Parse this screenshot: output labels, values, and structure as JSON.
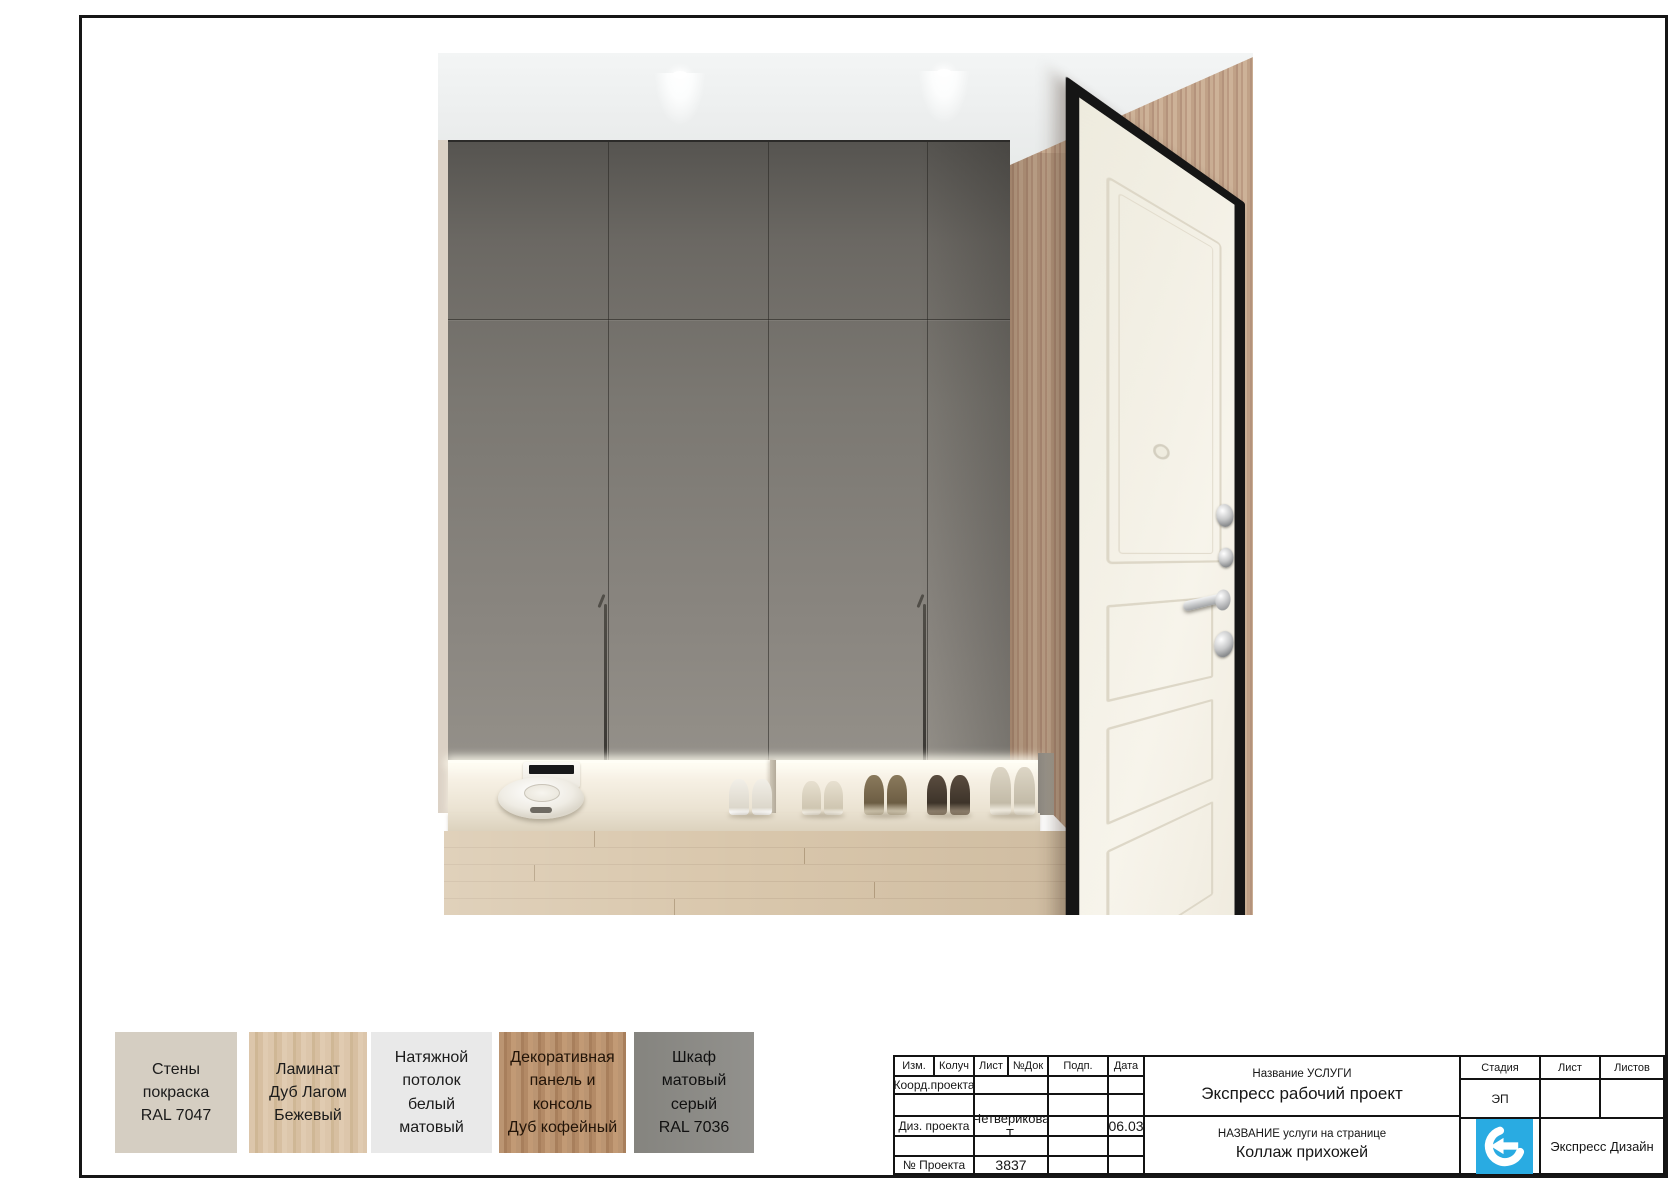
{
  "titleblock": {
    "header_cols": [
      "Изм.",
      "Колуч",
      "Лист",
      "№Док",
      "Подп.",
      "Дата"
    ],
    "rows": {
      "coord": {
        "label": "Коорд.проекта",
        "value": "",
        "sign": "",
        "date": ""
      },
      "designer": {
        "label": "Диз. проекта",
        "value": "Четверикова Т.",
        "sign": "",
        "date": "06.03"
      },
      "project": {
        "label": "№ Проекта",
        "value": "3837",
        "sign": "",
        "date": ""
      }
    },
    "service": {
      "label": "Название УСЛУГИ",
      "value": "Экспресс рабочий проект"
    },
    "page": {
      "label": "НАЗВАНИЕ услуги на странице",
      "value": "Коллаж прихожей"
    },
    "stage": {
      "label": "Стадия",
      "value": "ЭП"
    },
    "sheet_label": "Лист",
    "sheets_label": "Листов",
    "company": "Экспресс Дизайн",
    "logo_color": "#29abe2"
  },
  "swatches": [
    {
      "lines": [
        "Стены",
        "покраска",
        "RAL 7047"
      ],
      "color": "#d5cec2"
    },
    {
      "lines": [
        "Ламинат",
        "Дуб Лагом",
        "Бежевый"
      ],
      "color": "#d7bfa1"
    },
    {
      "lines": [
        "Натяжной",
        "потолок",
        "белый",
        "матовый"
      ],
      "color": "#e9e9e9"
    },
    {
      "lines": [
        "Декоративная",
        "панель и консоль",
        "Дуб кофейный"
      ],
      "color": "#b38a66"
    },
    {
      "lines": [
        "Шкаф",
        "матовый",
        "серый",
        "RAL 7036"
      ],
      "color": "#8b8a86"
    }
  ],
  "render_scene": {
    "wardrobe_color": "#7b7872",
    "wood_wall_color": "#c1a287",
    "floor_color": "#d9c7ac",
    "door_leaf_color": "#f3efe4",
    "niche_items": [
      "robot-vacuum",
      "shoes"
    ]
  }
}
